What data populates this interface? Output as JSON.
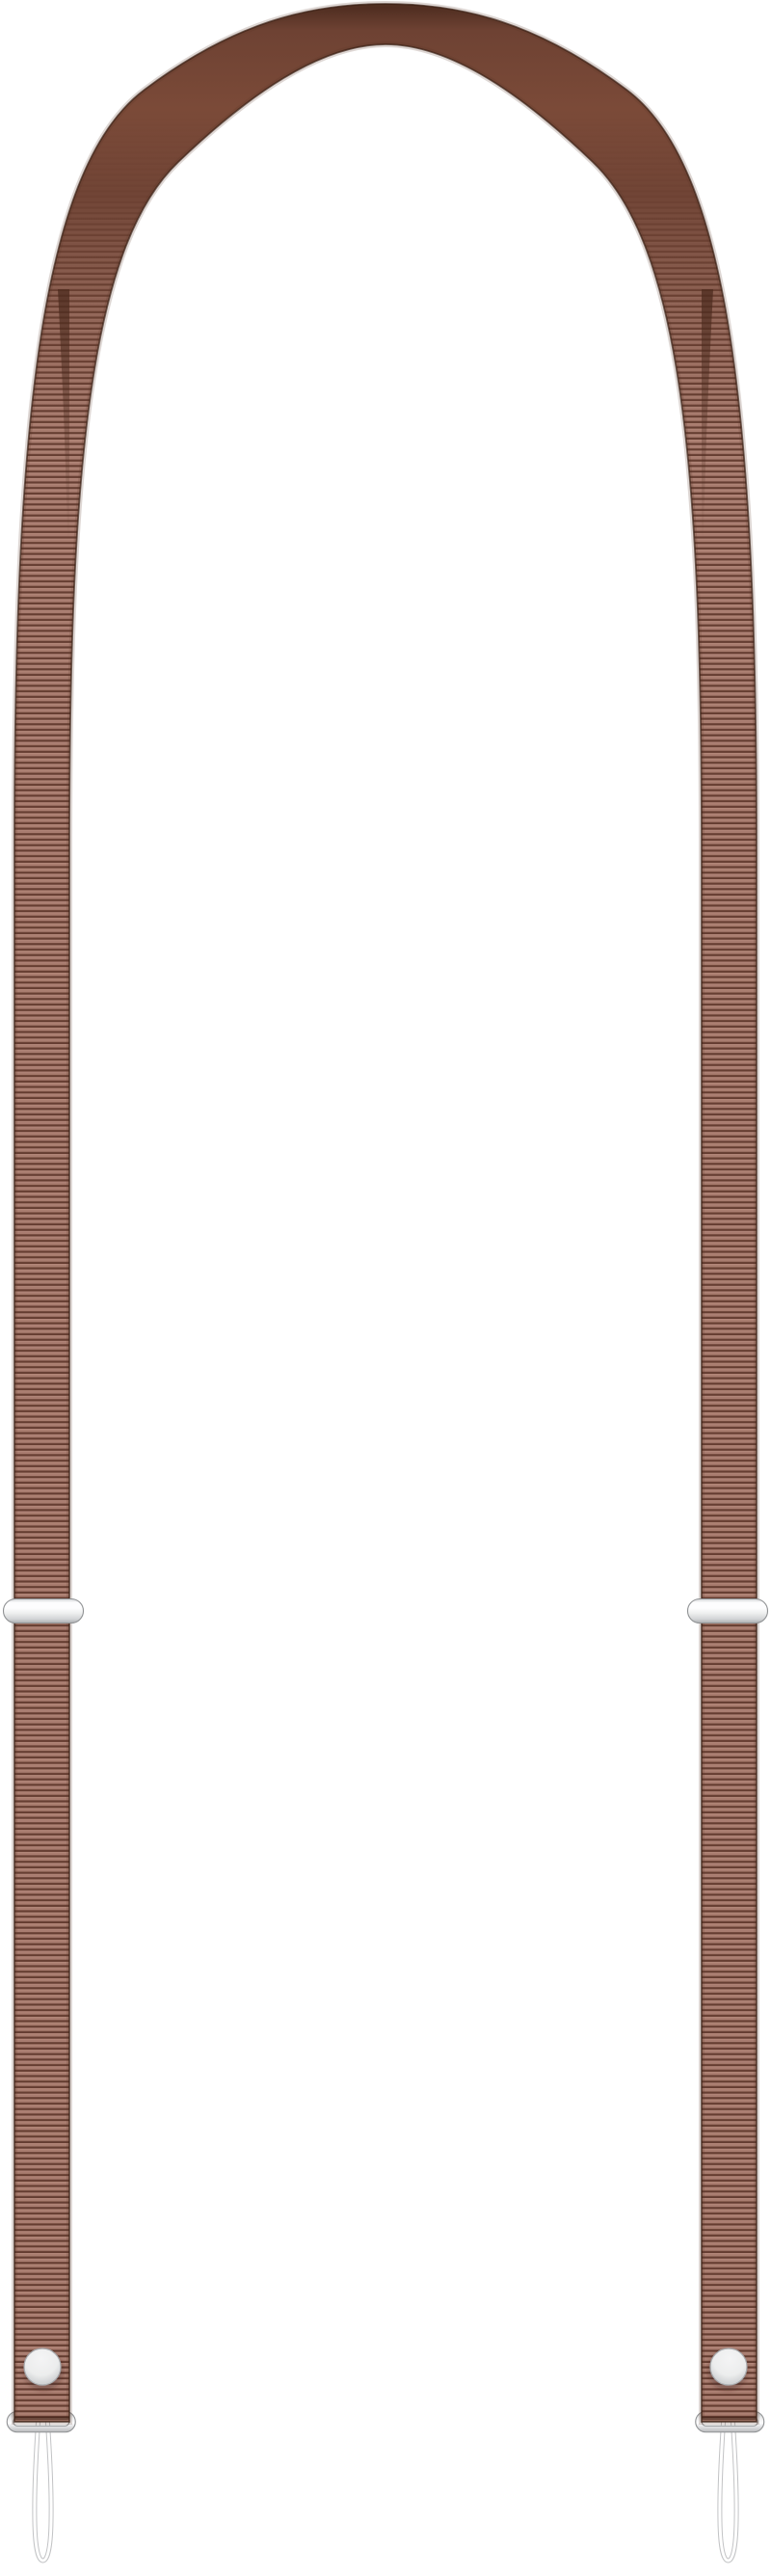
{
  "product": {
    "name": "Brown adjustable lanyard strap",
    "description": "Product photo of a long brown ribbed webbing lanyard strap forming an inverted U, smooth leather-like fold at the top, with a silver slide adjuster on each side, and at each end a silver snap button, a silver metal end loop and a thin white elastic cord loop hanging down"
  },
  "colors": {
    "background": "#ffffff",
    "rib-light": "#a87c6f",
    "rib-highlight": "#b98e80",
    "rib-dark": "#5f382b",
    "strap-edge": "#3c2217",
    "strap-edge-soft": "#5a3526",
    "arch-top-dark": "#46271b",
    "arch-mid": "#6e4233",
    "arch-highlight": "#7b4a38",
    "inner-shadow": "#4b2a1d",
    "metal-highlight": "#fdfdfe",
    "metal-light": "#eceded",
    "metal-mid": "#d2d4d6",
    "metal-dark": "#a8aaad",
    "metal-outline": "#8f9193",
    "snap-light": "#f4f4f5",
    "snap-dark": "#bfc1c3",
    "snap-shadow": "rgba(60,35,22,0.30)",
    "cord-white": "#ffffff",
    "cord-outline": "#c2c3c5"
  }
}
